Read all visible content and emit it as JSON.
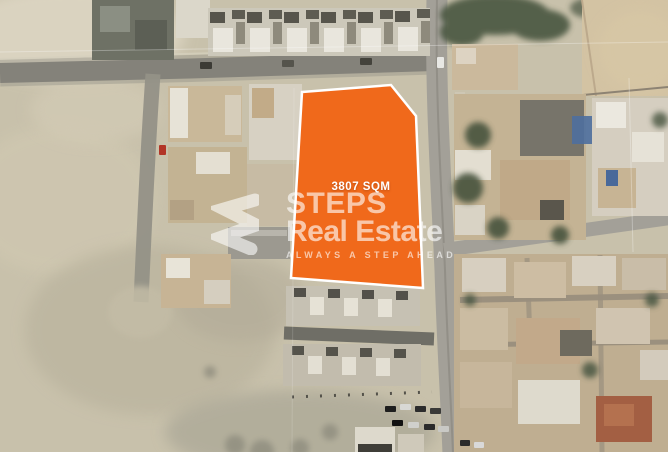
{
  "listing_map": {
    "type": "satellite-photo-with-plot-overlay",
    "plot": {
      "area_label": "3807 SQM",
      "fill_color": "#F0691B",
      "border_color": "#FFFFFF"
    },
    "watermark": {
      "logo_icon": "steps-logo",
      "brand_top": "STEPS",
      "brand_bottom": "Real Estate",
      "tagline": "ALWAYS A STEP AHEAD",
      "text_color": "rgba(255,255,255,0.62)"
    }
  }
}
